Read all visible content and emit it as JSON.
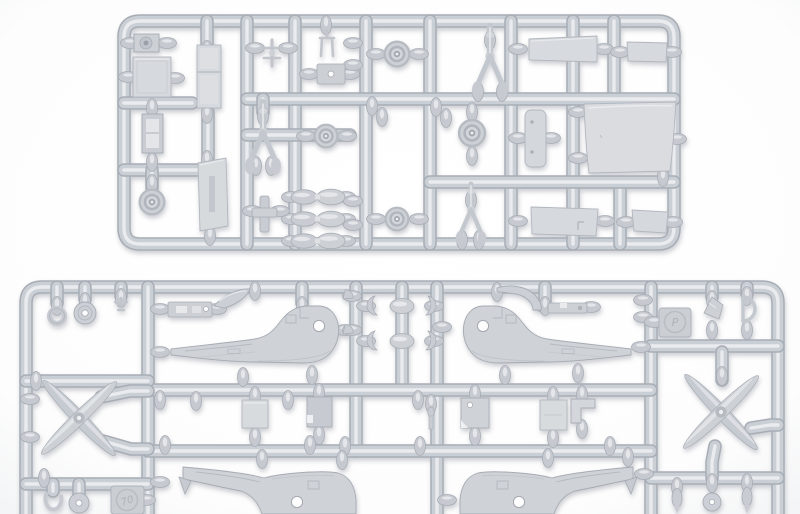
{
  "meta": {
    "type": "photograph",
    "subject": "Two injection-molded polystyrene model-kit sprues (small helicopter kit) on a white studio background",
    "crop_note": "lower sprue is cut off by the bottom edge of the photo"
  },
  "palette": {
    "background": "#fdfdfe",
    "plastic_base": "#cacfd5",
    "plastic_highlight": "#e9ebee",
    "plastic_shadow": "#a8adb5",
    "part_surface": "#d6d9dd"
  },
  "sprues": [
    {
      "id": "A",
      "position": "top",
      "shape": "rounded rectangular frame with five vertical runners",
      "visible_parts": {
        "road_wheels": 5,
        "landing_gear_struts": 3,
        "flat_cabin_panels": 8,
        "linked_tank_halves": 3,
        "small_fittings": 7
      },
      "markings": []
    },
    {
      "id": "B",
      "position": "bottom",
      "shape": "wide rounded rectangular frame, cropped at photo bottom",
      "visible_parts": {
        "rotor_blade_sets": 2,
        "fuselage_halves": 4,
        "rotor_head_cranks": 4,
        "small_fittings": 20
      },
      "markings": [
        {
          "id": "mold-stamp-left",
          "text": "70"
        },
        {
          "id": "mold-stamp-right",
          "text": "P"
        }
      ]
    }
  ]
}
